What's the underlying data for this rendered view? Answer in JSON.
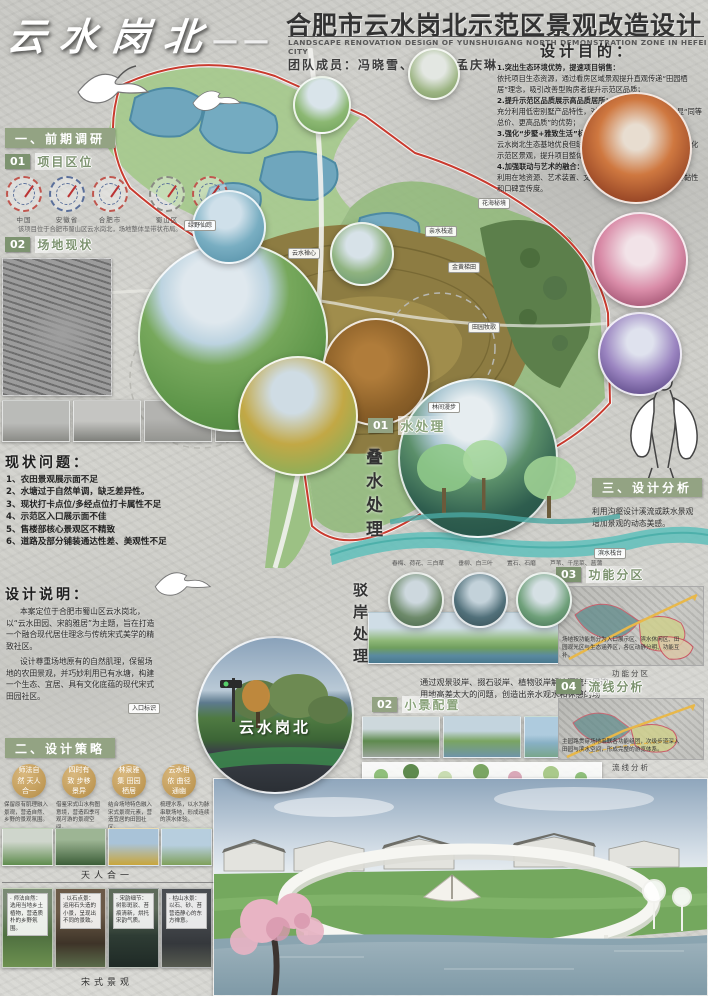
{
  "header": {
    "logo": "云水岗北",
    "dash": "— —",
    "title": "合肥市云水岗北示范区景观改造设计",
    "subtitle": "LANDSCAPE RENOVATION DESIGN OF YUNSHUIGANG NORTH DEMONSTRATION ZONE IN HEFEI CITY",
    "team": "团队成员：冯晓雪、臧简、孟庆琳"
  },
  "purpose": {
    "heading": "设计目的：",
    "lines": [
      "1.突出生态环境优势，提速项目销售：",
      "依托项目生态资源，通过看房区域景观提升直观传递“田园栖居”理念，吸引改善型购房者提升示范区品质；",
      "2.提升示范区品质展示高品质居所：",
      "充分利用低密别墅产品特性，对标主城区高价刚需盘，凸显“同等总价、更高品质”的优势；",
      "3.强化“步墅+雅致生活”标签：",
      "云水岗北生态基地优良但缺乏整体规划梳理，需彻底放大、优化示范区景观，提升项目整体品质感；",
      "4.加强联动与艺术的融合：",
      "利用在地资源、艺术装置、文化市集等互动场景，增强游客黏性和口碑宣传度。"
    ]
  },
  "research": {
    "heading": "一、前期调研",
    "s1_num": "01",
    "s1_title": "项目区位",
    "loc_labels": [
      "中国",
      "安徽省",
      "合肥市",
      "蜀山区",
      "云水岗北"
    ],
    "loc_caption": "该项目位于合肥市蜀山区云水岗北，场地整体呈带状布局。",
    "s2_num": "02",
    "s2_title": "场地现状"
  },
  "problems": {
    "heading": "现状问题：",
    "items": [
      "1、农田景观展示面不足",
      "2、水塘过于自然单调，缺乏差异性。",
      "3、现状打卡点位/多经点位打卡属性不足",
      "4、示范区入口展示面不佳",
      "5、售楼部核心景观区不精致",
      "6、道路及部分铺装通达性差、美观性不足"
    ]
  },
  "note": {
    "heading": "设计说明：",
    "p1": "本案定位于合肥市蜀山区云水岗北，以“云水田园、宋韵雅居”为主题，旨在打造一个融合现代居住理念与传统宋式美学的精致社区。",
    "p2": "设计尊重场地原有的自然肌理，保留场地的农田景观，并巧妙利用已有水塘，构建一个生态、宜居、具有文化底蕴的现代宋式田园社区。"
  },
  "strategy": {
    "heading": "二、设计策略",
    "circles": [
      "师法自然 天人合一",
      "四时有致 步移景异",
      "林泉雅集 田园栖居",
      "云水相依 曲径通幽"
    ],
    "captions": [
      "保留原有肌理融入景观，营造自然、乡野的景观氛围。",
      "借鉴宋式山水构图意境，营造四季可观可游的景观空间。",
      "结合场地特色融入宋式景观元素，营造宜居的田园社区。",
      "梳理水系，以水为脉串联场地，形成连续的滨水体验。"
    ],
    "divider1": "天人合一",
    "song_captions": [
      "· 师法自然：选用当地乡土植物，营造质朴的乡野氛围。",
      "· 以石点景：运用石头造的小景，呈现出不同的景致。",
      "· 宋韵细节：树影斑驳、苔痕清新，烘托宋韵气质。",
      "· 枯山水景：以石、砂、苔营造静心的东方禅意。"
    ],
    "divider2": "宋式景观"
  },
  "water": {
    "num": "01",
    "title": "水处理",
    "vertical": "叠水处理"
  },
  "analysis": {
    "heading": "三、设计分析",
    "line1": "利用沟壑设计溪流或跌水景观",
    "line2": "增加景观的动态美感。"
  },
  "bank": {
    "vertical": "驳岸处理",
    "plants": [
      "春梅、荷花、三白草",
      "垂柳、白三叶",
      "置石、石磨",
      "芦苇、千屈菜、菖蒲"
    ],
    "text": "通过观景驳岸、掇石驳岸、植物驳岸解决河流与周边用地高差太大的问题，创造出亲水观水和休憩的场所。"
  },
  "scenery": {
    "num": "02",
    "title": "小景配置"
  },
  "zoning": {
    "num": "03",
    "title": "功能分区",
    "caption": "功能分区",
    "text": "场地按功能划分为入口展示区、滨水休闲区、田园观光区与生态涵养区，各区动静分明、功能互补。"
  },
  "flow": {
    "num": "04",
    "title": "流线分析",
    "caption": "流线分析",
    "text": "主园路贯穿场地串联各功能组团，次级步道深入田园与滨水空间，形成完整的游览体系。"
  },
  "plan_labels": [
    "绿野仙踪",
    "云水禅心",
    "亲水栈道",
    "花海秘境",
    "金黄梯田",
    "田园牧歌",
    "林间漫步",
    "滨水栈台",
    "入口标识"
  ],
  "entrance_sign": "云水岗北",
  "colors": {
    "banner_green": "#93a383",
    "badge_green": "#7d9370",
    "boundary_red": "#c93a2e",
    "stream_teal": "#5fc0bb",
    "field_gold": "#9a8a4a",
    "gold_circle": "#c9a063"
  }
}
